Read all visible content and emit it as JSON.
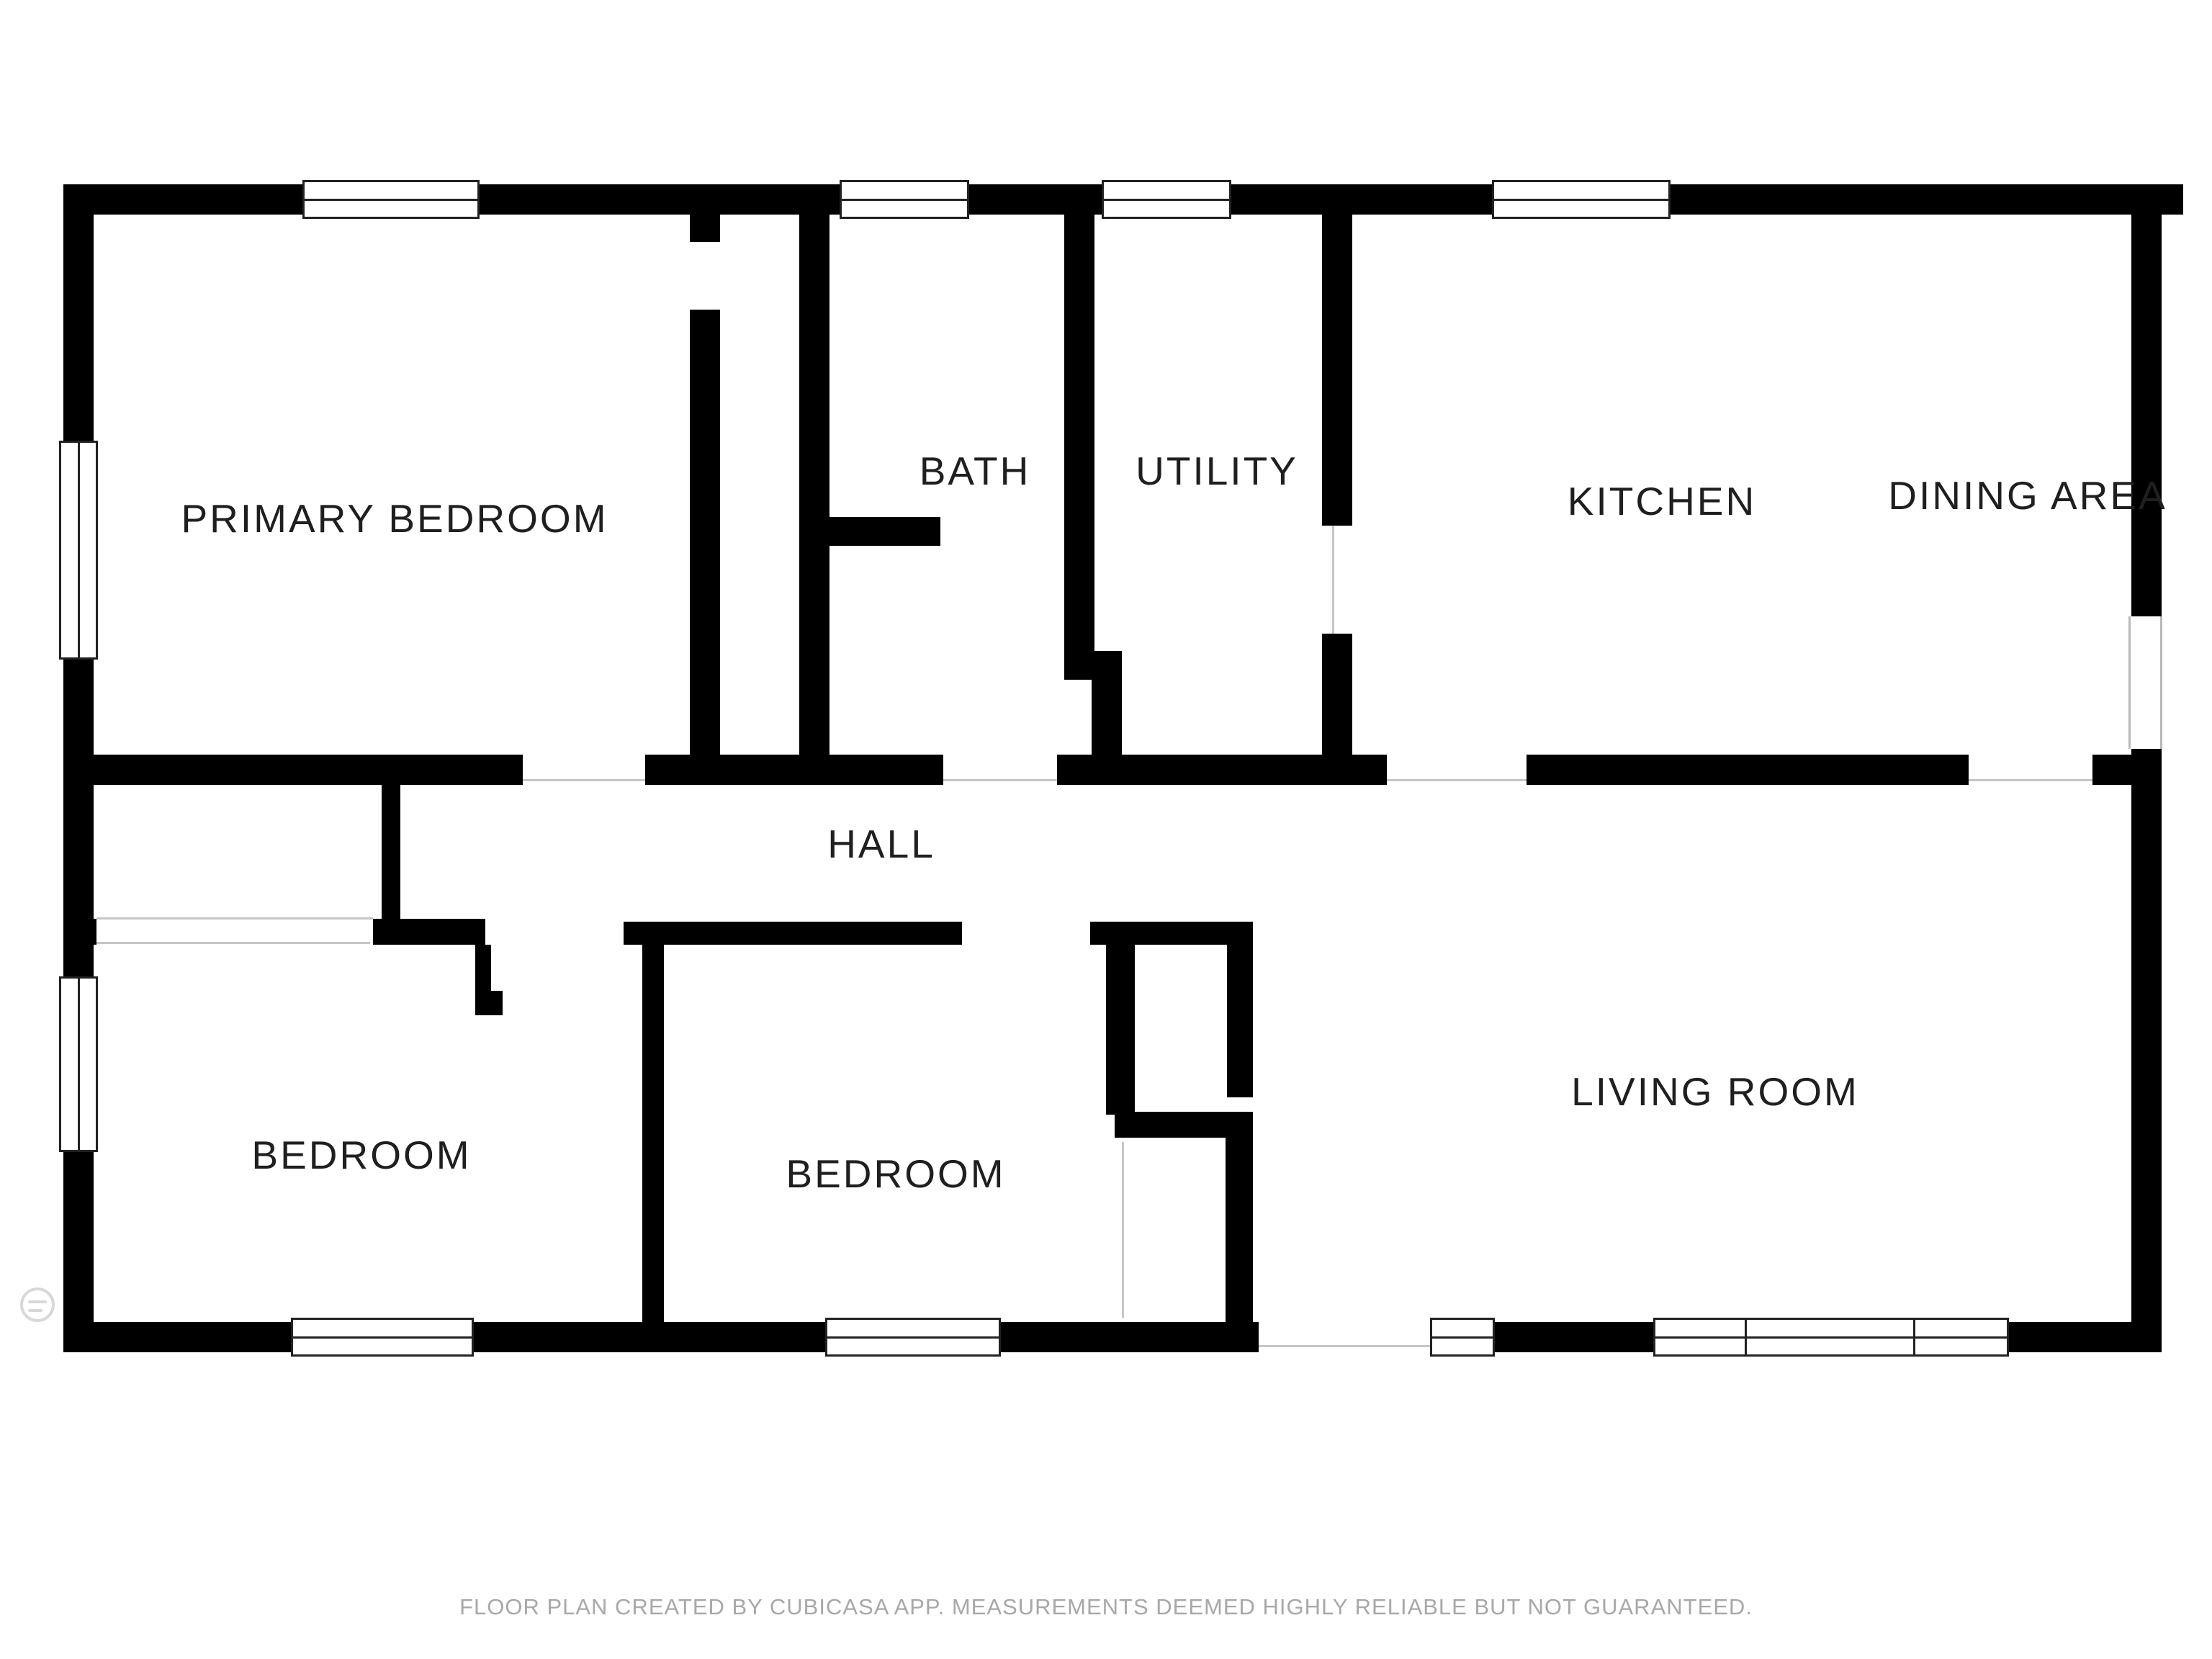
{
  "page": {
    "title": "Floor plan",
    "background_color": "#ffffff",
    "wall_color": "#000000",
    "floor_edge_line_color": "#c6c6c6",
    "label_color": "#1f1f1f",
    "footer_color": "#a8a8a8"
  },
  "rooms": [
    {
      "id": "primary-bedroom",
      "label": "PRIMARY BEDROOM"
    },
    {
      "id": "bath",
      "label": "BATH"
    },
    {
      "id": "utility",
      "label": "UTILITY"
    },
    {
      "id": "kitchen",
      "label": "KITCHEN"
    },
    {
      "id": "dining-area",
      "label": "DINING AREA"
    },
    {
      "id": "hall",
      "label": "HALL"
    },
    {
      "id": "bedroom-left",
      "label": "BEDROOM"
    },
    {
      "id": "bedroom-middle",
      "label": "BEDROOM"
    },
    {
      "id": "living-room",
      "label": "LIVING ROOM"
    }
  ],
  "footer": {
    "disclaimer": "FLOOR PLAN CREATED BY CUBICASA APP. MEASUREMENTS DEEMED HIGHLY RELIABLE BUT NOT GUARANTEED."
  },
  "branding": {
    "logo": "cubicasa-logo"
  }
}
